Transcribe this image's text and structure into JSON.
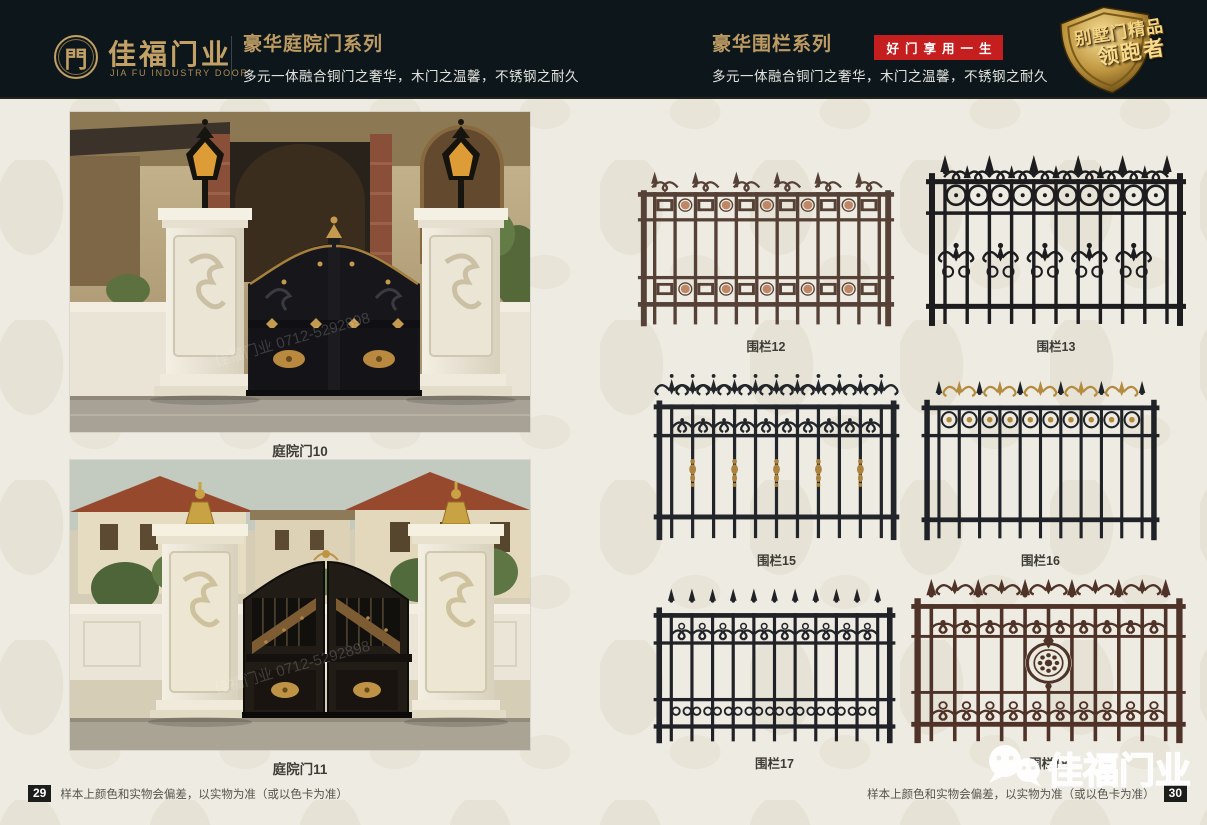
{
  "header": {
    "logo": {
      "symbol": "門",
      "brand_cn": "佳福门业",
      "brand_en": "JIA FU INDUSTRY DOOR"
    },
    "door_series": {
      "title": "豪华庭院门系列",
      "subtitle": "多元一体融合铜门之奢华，木门之温馨，不锈钢之耐久"
    },
    "fence_series": {
      "title": "豪华围栏系列",
      "badge": "好门享用一生",
      "subtitle": "多元一体融合铜门之奢华，木门之温馨，不锈钢之耐久"
    },
    "shield_badge": {
      "line1": "别墅门精品",
      "line2": "领跑者"
    }
  },
  "gates": [
    {
      "label": "庭院门10"
    },
    {
      "label": "庭院门11"
    }
  ],
  "fences": [
    {
      "label": "围栏12",
      "variant": "panel",
      "body": "#564137",
      "accent": "#c08767"
    },
    {
      "label": "围栏13",
      "variant": "circles",
      "body": "#1d1d1f",
      "accent": "#2c2c2e"
    },
    {
      "label": "围栏15",
      "variant": "fleur",
      "body": "#22252a",
      "accent": "#ab833f"
    },
    {
      "label": "围栏16",
      "variant": "fleur2",
      "body": "#1f2226",
      "accent": "#b58c3f"
    },
    {
      "label": "围栏17",
      "variant": "scroll",
      "body": "#202227",
      "accent": "#2a2c31"
    },
    {
      "label": "围栏18",
      "variant": "medallion",
      "body": "#503328",
      "accent": "#7d5240"
    }
  ],
  "footer": {
    "left_page": "29",
    "right_page": "30",
    "disclaimer": "样本上颜色和实物会偏差，以实物为准（或以色卡为准）"
  },
  "watermark": {
    "photo_text": "佳福门业 0712-5292898",
    "logo_text": "佳福门业"
  },
  "colors": {
    "header_bg": "#0d171b",
    "gold": "#c2a066",
    "badge_red": "#c41e1e",
    "page_bg": "#eeebe2",
    "caption_text": "#3d3c37"
  }
}
